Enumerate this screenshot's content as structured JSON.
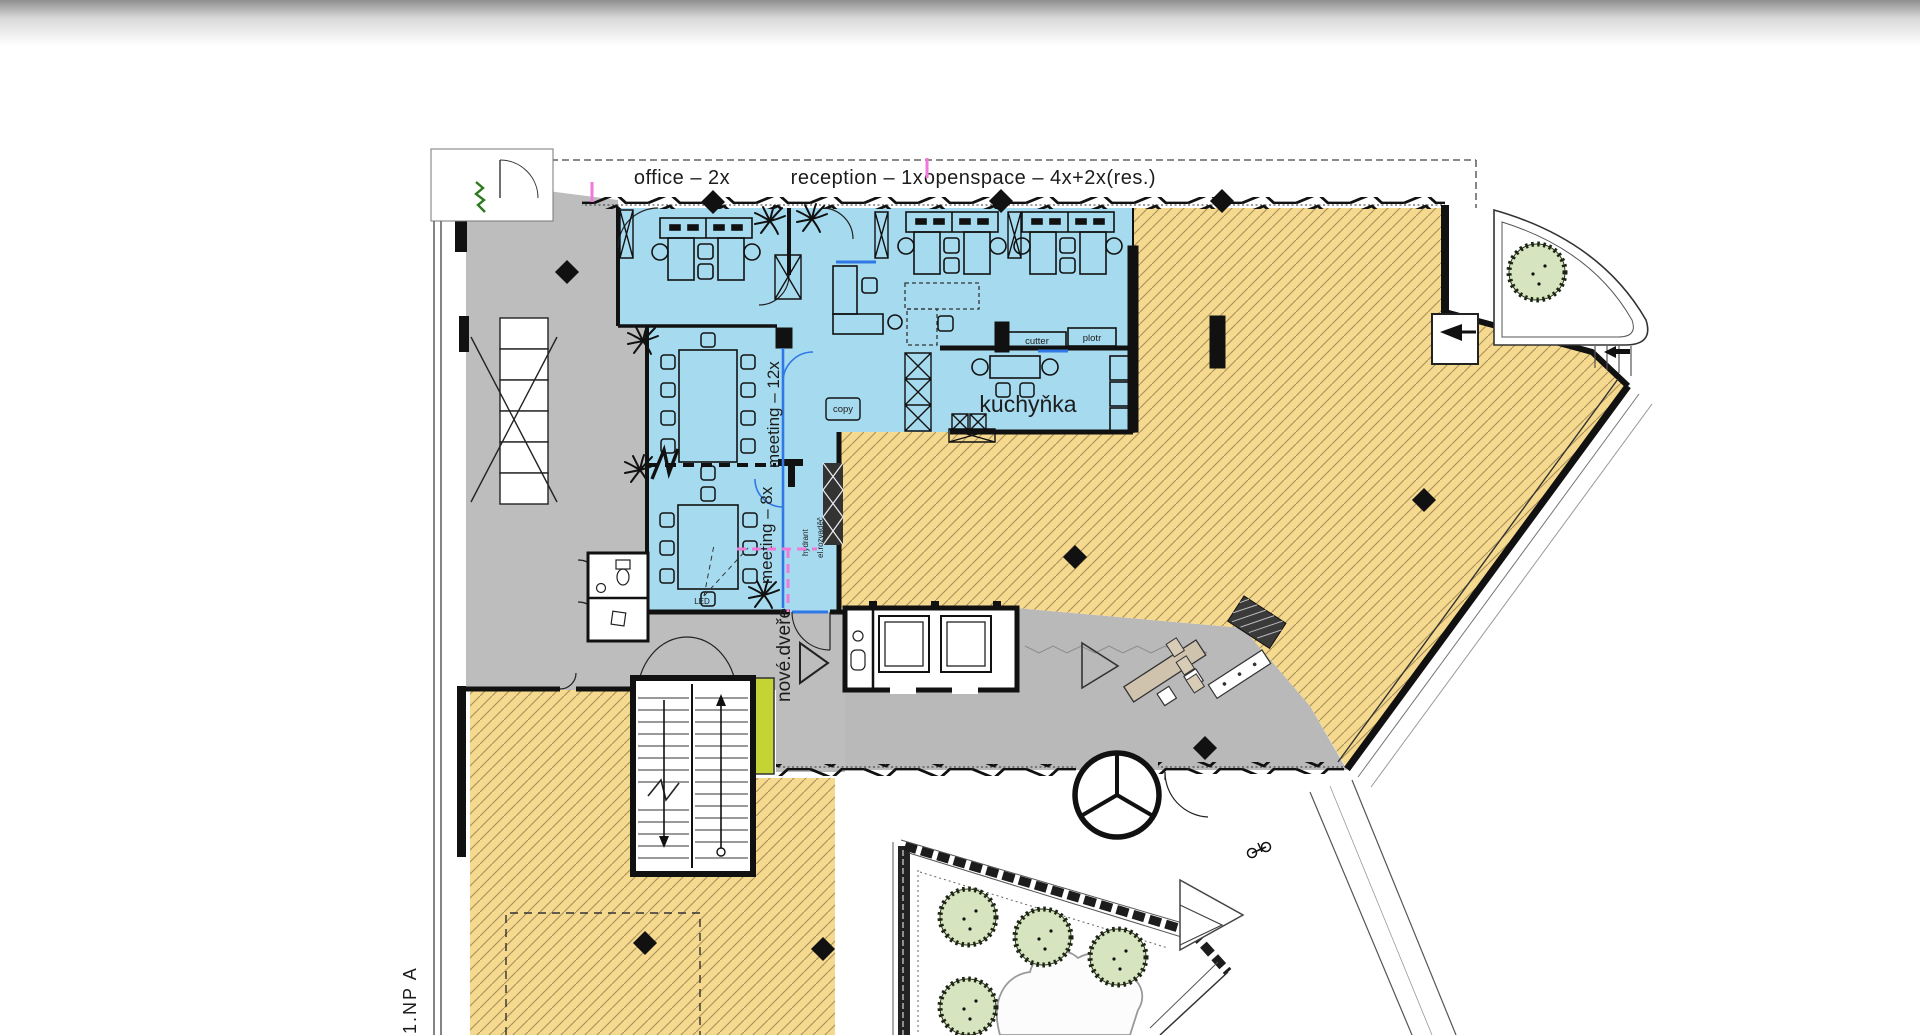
{
  "plan": {
    "floor_tag": "1.NP A",
    "zone_labels": {
      "office": "office – 2x",
      "reception": "reception – 1x",
      "openspace": "openspace – 4x+2x(res.)"
    },
    "rooms": {
      "kitchen": "kuchyňka",
      "meeting_large": "meeting – 12x",
      "meeting_small": "meeting – 8x"
    },
    "annotations": {
      "new_door": "nové.dveře",
      "hydrant": "hydrant",
      "electrical": "el.rozvaděč",
      "cutter": "cutter",
      "plotter": "plotr",
      "copier": "copy",
      "led": "LED"
    },
    "colors": {
      "zone_blue": "#a6dbef",
      "lease_yellow": "#f5d98f",
      "hatch_line": "#a8905a",
      "core_gray": "#bdbdbd",
      "accent_green": "#c5d435",
      "accent_magenta": "#f07ad9",
      "new_wall_blue": "#2f78e6",
      "tree_green": "#d6e4c0",
      "desk_tan": "#cfc3ae",
      "wall_black": "#141414"
    }
  }
}
